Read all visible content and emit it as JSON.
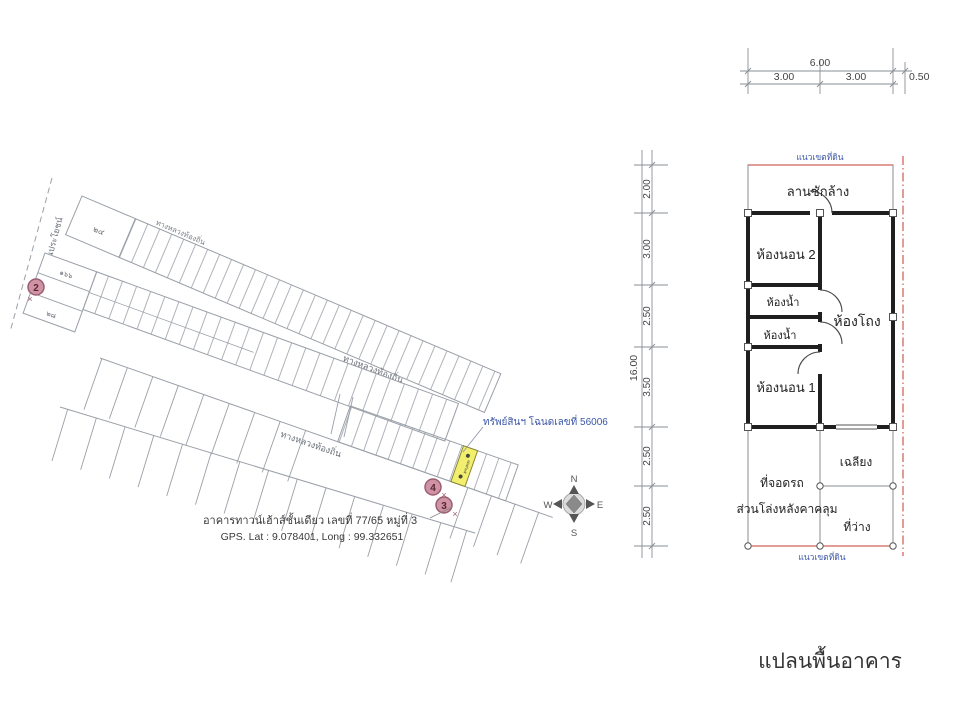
{
  "site_map": {
    "public_road_label": "ทางสาธารณประโยชน์",
    "frontage_road_label": "ทางหลวงท้องถิ่น",
    "road_label_1": "ทางหลวงท้องถิ่น",
    "road_label_2": "ทางหลวงท้องถิ่น",
    "parcels": {
      "band1_left": "๒๔",
      "band2_left_top": "๑๖๖",
      "band2_left_bottom": "๒๘",
      "subject": "๗๗/๖๕"
    },
    "property_note": "ทรัพย์สินฯ โฉนดเลขที่ 56006",
    "markers": [
      "2",
      "4",
      "3"
    ],
    "marker_x": "×",
    "caption_building": "อาคารทาวน์เฮ้าส์ชั้นเดียว เลขที่ 77/65 หมู่ที่ 3",
    "caption_gps": "GPS. Lat : 9.078401, Long : 99.332651",
    "compass": {
      "n": "N",
      "e": "E",
      "s": "S",
      "w": "W"
    }
  },
  "floor_plan": {
    "title": "แปลนพื้นอาคาร",
    "boundary_label_top": "แนวเขตที่ดิน",
    "boundary_label_bottom": "แนวเขตที่ดิน",
    "dim_top": {
      "total": "6.00",
      "seg1": "3.00",
      "seg2": "3.00",
      "side": "0.50"
    },
    "dim_left": {
      "total": "16.00",
      "segs": [
        "2.00",
        "3.00",
        "2.50",
        "3.50",
        "2.50",
        "2.50"
      ]
    },
    "rooms": {
      "laundry": "ลานซักล้าง",
      "bedroom2": "ห้องนอน 2",
      "bath1": "ห้องน้ำ",
      "bath2": "ห้องน้ำ",
      "hall": "ห้องโถง",
      "bedroom1": "ห้องนอน 1",
      "porch": "เฉลียง",
      "carport": "ที่จอดรถ",
      "covered_area": "ส่วนโล่งหลังคาคลุม",
      "vacant": "ที่ว่าง"
    }
  },
  "colors": {
    "boundary_red": "#c2392b",
    "highlight_yellow": "#f2ee6e",
    "note_blue": "#3b56a6",
    "marker_pink": "#cf93a6",
    "map_line_gray": "#9aa0a8"
  }
}
